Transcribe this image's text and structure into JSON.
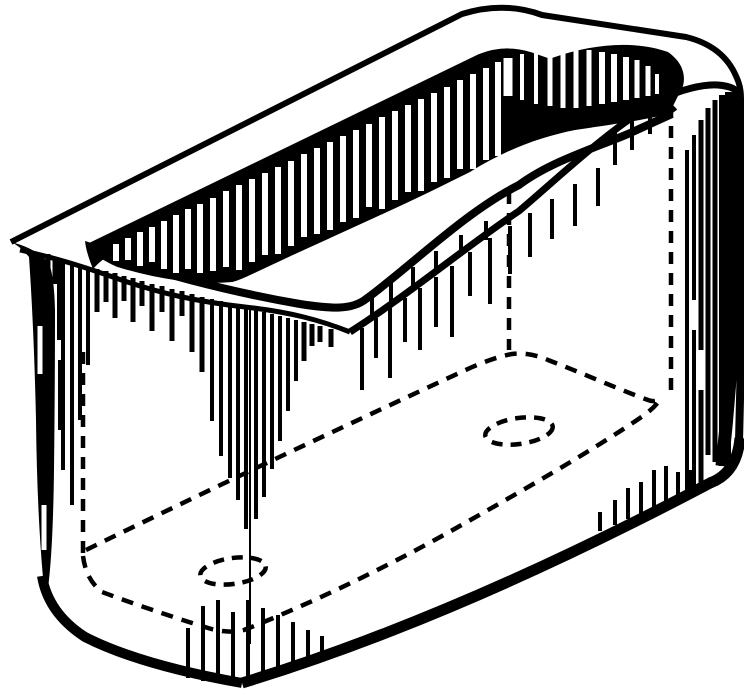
{
  "figure": {
    "alt": "Black and white technical line drawing of an open-top rectangular box viewed in perspective, with hatched shading, hidden edges shown dashed, and two dashed holes in the bottom",
    "kind": "line-art-illustration"
  },
  "colors": {
    "ink": "#000000",
    "paper": "#ffffff"
  },
  "drawing": {
    "viewbox": "0 0 744 689",
    "outline_paths": [
      {
        "name": "rim-outer-top-edge",
        "d": "M 11 242 L 462 14 Q 504 1 542 15 L 686 37 Q 723 46 736 76 Q 741 86 741 98",
        "w": 6
      },
      {
        "name": "right-outer-edge",
        "d": "M 741 98 L 743 270 L 739 442",
        "w": 8
      },
      {
        "name": "right-edge-thick-band",
        "d": "M 736 92 C 739 200 738 320 722 466",
        "w": 13
      },
      {
        "name": "bottom-right-corner",
        "d": "M 740 438 Q 737 473 710 483",
        "w": 11
      },
      {
        "name": "bottom-outer-edge",
        "d": "M 242 683 Q 455 618 712 482",
        "w": 11
      },
      {
        "name": "bottom-left-corner",
        "d": "M 242 683 Q 140 665 85 637 Q 48 613 42 576",
        "w": 10
      },
      {
        "name": "rim-inner-edge-far",
        "d": "M 90 247 L 480 58 Q 505 48 530 56 L 650 98 Q 668 104 674 112",
        "w": 8
      },
      {
        "name": "rim-inner-edge-near",
        "d": "M 92 250 C 150 271 230 292 300 304 C 332 309 352 310 366 299 C 410 267 465 212 519 185 C 550 162 592 149 628 134 L 672 114",
        "w": 8
      },
      {
        "name": "rim-bottom-edge-left",
        "d": "M 20 250 C 55 258 75 264 110 276 C 160 294 200 302 245 307 C 290 312 320 320 350 332",
        "w": 5
      },
      {
        "name": "rim-bottom-edge-right",
        "d": "M 350 332 C 415 290 468 245 519 211 C 558 178 610 128 658 101 C 680 89 705 84 718 85 C 730 86 737 89 741 96",
        "w": 7
      },
      {
        "name": "opening-shadow-boundary",
        "d": "M 672 104 C 640 108 600 111 565 116 C 530 123 505 140 470 168 C 430 190 360 221 290 253 C 258 268 240 277 232 279 C 200 282 160 277 118 264 Q 102 257 92 248",
        "w": 6
      },
      {
        "name": "front-corner-line",
        "d": "M 250 309 L 250 644",
        "w": 2
      }
    ],
    "fills": [
      {
        "name": "inner-far-wall-shadow",
        "d": "M 92 248 L 480 58 Q 505 48 530 56 L 650 98 Q 668 104 674 112 C 648 120 615 124 575 130 C 540 137 505 150 470 172 C 430 192 360 222 290 253 C 258 268 240 277 232 279 C 200 282 160 277 118 264 Q 102 257 92 248 Z"
      },
      {
        "name": "inner-corner-wedge-right",
        "d": "M 552 58 C 592 44 634 40 668 52 C 682 62 686 74 683 86 C 678 96 675 102 672 108 C 635 112 600 116 565 122 C 558 98 554 76 552 58 Z"
      },
      {
        "name": "inner-corner-wedge-left",
        "d": "M 85 241 C 95 244 104 248 112 253 C 105 258 98 263 93 269 C 89 259 86 250 85 241 Z"
      },
      {
        "name": "left-face-shade-band",
        "d": "M 11 242 Q 20 246 29 257 Q 34 330 36 420 Q 37 510 43 578 L 48 588 Q 53 550 54 470 Q 55 380 55 310 Q 54 272 48 262 Q 35 248 11 242 Z"
      }
    ],
    "line_groups": [
      {
        "name": "far-wall-hatch",
        "color": "paper",
        "w": 6,
        "lines": [
          [
            116,
            244,
            261
          ],
          [
            128,
            238,
            260
          ],
          [
            140,
            232,
            266
          ],
          [
            152,
            227,
            262
          ],
          [
            164,
            221,
            269
          ],
          [
            176,
            215,
            273
          ],
          [
            188,
            209,
            269
          ],
          [
            200,
            204,
            273
          ],
          [
            213,
            198,
            271
          ],
          [
            226,
            191,
            267
          ],
          [
            239,
            185,
            270
          ],
          [
            252,
            179,
            262
          ],
          [
            265,
            173,
            255
          ],
          [
            278,
            167,
            254
          ],
          [
            291,
            161,
            246
          ],
          [
            304,
            154,
            237
          ],
          [
            317,
            148,
            234
          ],
          [
            330,
            142,
            230
          ],
          [
            343,
            136,
            222
          ],
          [
            356,
            130,
            218
          ],
          [
            369,
            124,
            207
          ],
          [
            382,
            117,
            209
          ],
          [
            395,
            111,
            200
          ],
          [
            408,
            105,
            192
          ],
          [
            421,
            99,
            191
          ],
          [
            434,
            93,
            182
          ],
          [
            447,
            87,
            178
          ],
          [
            460,
            80,
            169
          ],
          [
            473,
            74,
            169
          ],
          [
            486,
            68,
            160
          ],
          [
            498,
            62,
            156
          ],
          [
            508,
            58,
            96,
            9
          ],
          [
            522,
            54,
            100,
            4
          ],
          [
            536,
            50,
            104,
            4
          ],
          [
            550,
            48,
            106,
            5
          ],
          [
            563,
            46,
            108,
            5
          ],
          [
            576,
            48,
            108,
            5
          ],
          [
            589,
            50,
            106,
            5
          ],
          [
            602,
            52,
            104,
            6
          ],
          [
            614,
            54,
            102,
            6
          ],
          [
            626,
            57,
            100,
            6
          ],
          [
            637,
            60,
            98,
            5
          ],
          [
            648,
            66,
            96,
            5
          ],
          [
            657,
            74,
            94,
            4
          ]
        ]
      },
      {
        "name": "left-face-slits",
        "color": "paper",
        "w": 5,
        "lines": [
          [
            40,
            326,
            374
          ],
          [
            44,
            505,
            550
          ]
        ]
      },
      {
        "name": "rim-drips-left",
        "color": "ink",
        "w": 5,
        "lines": [
          [
            48,
            254,
            300
          ],
          [
            55,
            257,
            284
          ],
          [
            63,
            259,
            470,
            4
          ],
          [
            72,
            262,
            505,
            4
          ],
          [
            80,
            264,
            420,
            4
          ],
          [
            88,
            267,
            365,
            4
          ],
          [
            97,
            269,
            312
          ],
          [
            106,
            271,
            302
          ],
          [
            115,
            273,
            318
          ],
          [
            124,
            276,
            301
          ],
          [
            133,
            278,
            322
          ],
          [
            142,
            281,
            306
          ],
          [
            152,
            284,
            331
          ],
          [
            162,
            286,
            312
          ],
          [
            172,
            289,
            341
          ],
          [
            182,
            291,
            316
          ],
          [
            192,
            294,
            352
          ],
          [
            202,
            297,
            372
          ],
          [
            212,
            299,
            421,
            4
          ],
          [
            221,
            301,
            456,
            4
          ],
          [
            230,
            303,
            478,
            4
          ],
          [
            238,
            305,
            500,
            4
          ],
          [
            246,
            307,
            529,
            4
          ],
          [
            256,
            310,
            519,
            4
          ],
          [
            264,
            312,
            497,
            4
          ],
          [
            272,
            314,
            469,
            4
          ],
          [
            280,
            316,
            441,
            4
          ],
          [
            288,
            318,
            411,
            4
          ],
          [
            296,
            320,
            381,
            4
          ],
          [
            304,
            322,
            361
          ],
          [
            312,
            324,
            346
          ],
          [
            320,
            326,
            342
          ],
          [
            331,
            329,
            347
          ]
        ]
      },
      {
        "name": "rim-drips-right",
        "color": "ink",
        "w": 4,
        "lines": [
          [
            362,
            328,
            390
          ],
          [
            376,
            318,
            358
          ],
          [
            390,
            308,
            378
          ],
          [
            405,
            298,
            342
          ],
          [
            420,
            288,
            350
          ],
          [
            436,
            277,
            327
          ],
          [
            452,
            266,
            337
          ],
          [
            470,
            252,
            296
          ],
          [
            490,
            238,
            304
          ],
          [
            510,
            226,
            274
          ],
          [
            530,
            213,
            257
          ],
          [
            552,
            199,
            239
          ],
          [
            575,
            184,
            226
          ],
          [
            598,
            168,
            206
          ],
          [
            615,
            128,
            165
          ],
          [
            632,
            112,
            150
          ],
          [
            650,
            100,
            134
          ],
          [
            663,
            95,
            120
          ]
        ]
      },
      {
        "name": "inner-rim-drips",
        "color": "ink",
        "w": 4,
        "lines": [
          [
            372,
            296,
            318
          ],
          [
            391,
            282,
            306
          ],
          [
            413,
            267,
            291
          ],
          [
            436,
            251,
            272
          ],
          [
            461,
            235,
            255
          ],
          [
            486,
            221,
            240
          ]
        ]
      },
      {
        "name": "left-face-hatch",
        "color": "ink",
        "w": 4,
        "lines": [
          [
            59,
            262,
            340
          ],
          [
            60,
            360,
            430
          ]
        ]
      },
      {
        "name": "right-face-hatch",
        "color": "ink",
        "w": 5,
        "lines": [
          [
            687,
            150,
            492,
            4
          ],
          [
            694,
            135,
            300,
            4
          ],
          [
            694,
            330,
            488,
            4
          ],
          [
            701,
            120,
            350
          ],
          [
            701,
            390,
            483
          ],
          [
            708,
            108,
            455
          ],
          [
            715,
            100,
            462
          ],
          [
            722,
            95,
            466,
            6
          ],
          [
            728,
            92,
            458,
            6
          ]
        ]
      },
      {
        "name": "bottom-edge-spikes",
        "color": "ink",
        "w": 4,
        "lines": [
          [
            188,
            628,
            678
          ],
          [
            203,
            606,
            681
          ],
          [
            218,
            600,
            683
          ],
          [
            233,
            612,
            684
          ],
          [
            248,
            600,
            682
          ],
          [
            263,
            608,
            678
          ],
          [
            278,
            615,
            672
          ],
          [
            293,
            622,
            666
          ],
          [
            308,
            630,
            660
          ],
          [
            322,
            636,
            654
          ],
          [
            600,
            512,
            531
          ],
          [
            615,
            500,
            525
          ],
          [
            628,
            488,
            519
          ],
          [
            641,
            482,
            514
          ],
          [
            654,
            470,
            508
          ],
          [
            666,
            466,
            503
          ],
          [
            678,
            472,
            498
          ],
          [
            690,
            470,
            493
          ]
        ]
      }
    ],
    "dashed": {
      "w": 4.5,
      "pattern": "12 9",
      "verticals": [
        {
          "name": "hidden-edge-left",
          "x": 83,
          "y1": 352,
          "y2": 560
        },
        {
          "name": "hidden-edge-far-right",
          "x": 509,
          "y1": 192,
          "y2": 350
        },
        {
          "name": "hidden-edge-right",
          "x": 671,
          "y1": 105,
          "y2": 396
        }
      ],
      "paths": [
        {
          "name": "hidden-bottom-near-edge",
          "d": "M 83 556 Q 86 580 102 592 Q 150 610 208 628 Q 228 634 244 630 C 320 600 400 560 458 527 C 520 492 590 452 640 418 Q 655 408 661 398"
        },
        {
          "name": "hidden-bottom-far-edge",
          "d": "M 86 550 C 200 494 340 428 470 368 Q 495 357 512 354 Q 530 352 548 360 C 580 372 620 390 648 400 Q 656 403 661 398"
        }
      ],
      "ellipses": [
        {
          "name": "bottom-hole-left",
          "cx": 233,
          "cy": 571,
          "rx": 33,
          "ry": 13,
          "rot": -8
        },
        {
          "name": "bottom-hole-right",
          "cx": 519,
          "cy": 431,
          "rx": 34,
          "ry": 13,
          "rot": -8
        }
      ]
    }
  }
}
